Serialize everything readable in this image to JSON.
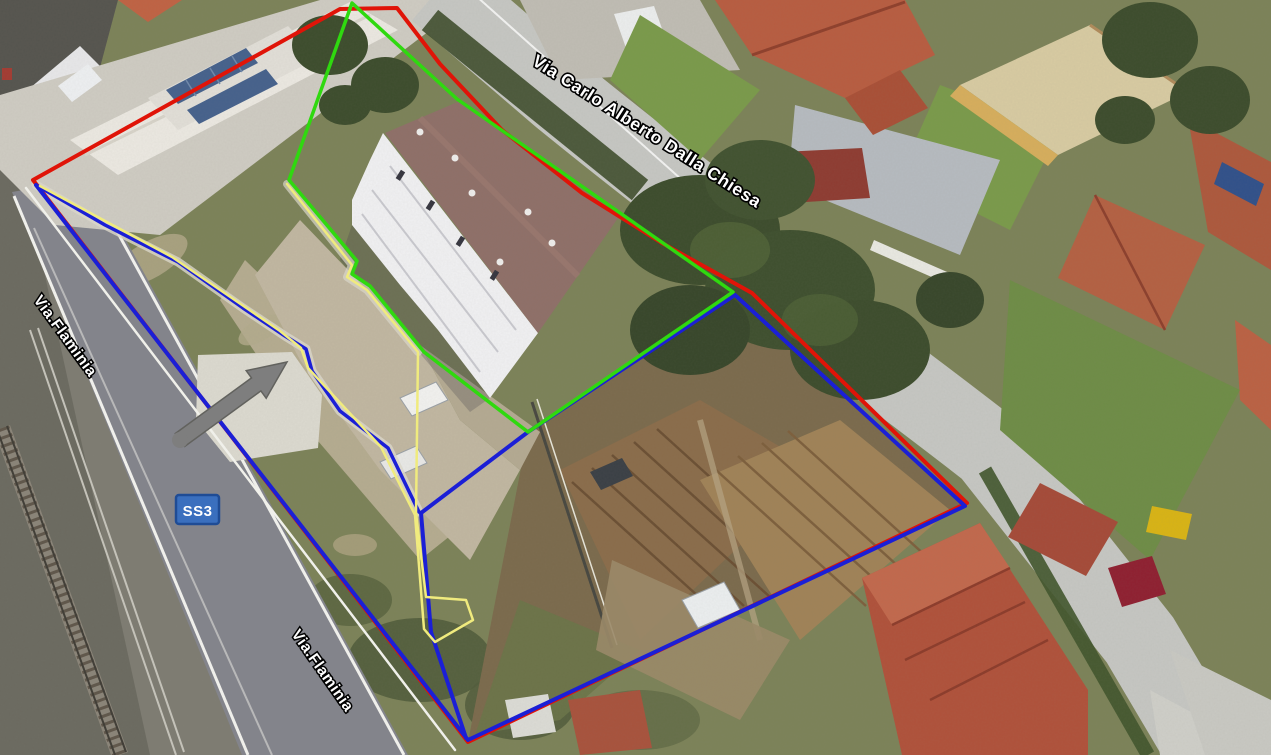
{
  "map_labels": {
    "street_main": "Via Carlo Alberto Dalla Chiesa",
    "street_flaminia_upper": "Via.Flaminia",
    "street_flaminia_lower": "Via.Flaminia"
  },
  "route_badge": {
    "label": "SS3",
    "fill": "#3a6fbe",
    "border": "#1f4c95",
    "text_color": "#ffffff"
  },
  "direction_arrow": {
    "color": "#7e7e7e",
    "outline": "#62625e"
  },
  "boundaries": {
    "red_outer": {
      "color": "#e01408",
      "width": "4",
      "points": "33,180 340,9 397,8 440,64 502,130 582,193 662,243 752,293 967,503 468,742"
    },
    "blue_perimeter": {
      "color": "#1b1fd6",
      "width": "4",
      "points": "36,185 468,740 965,506 735,295 528,432 421,513 431,632 466,738"
    },
    "blue_walkway": {
      "color": "#1b1fd6",
      "width": "3.5",
      "points": "36,185 105,225 178,262 243,308 285,336 306,349 312,371 340,411 388,448 419,512"
    },
    "green_parcel": {
      "color": "#2fd90f",
      "width": "3.5",
      "points": "352,3 457,99 733,292 528,432 424,352 370,286 352,274 357,261 289,180"
    },
    "yellow_strip": {
      "color": "#f0eb7e",
      "width": "2.5",
      "points": "287,184 352,265 347,277 367,290 418,352 416,513 426,597 466,600 473,620 435,642 424,629 415,515 381,447 308,368 301,348 280,331 172,257 40,186"
    }
  }
}
